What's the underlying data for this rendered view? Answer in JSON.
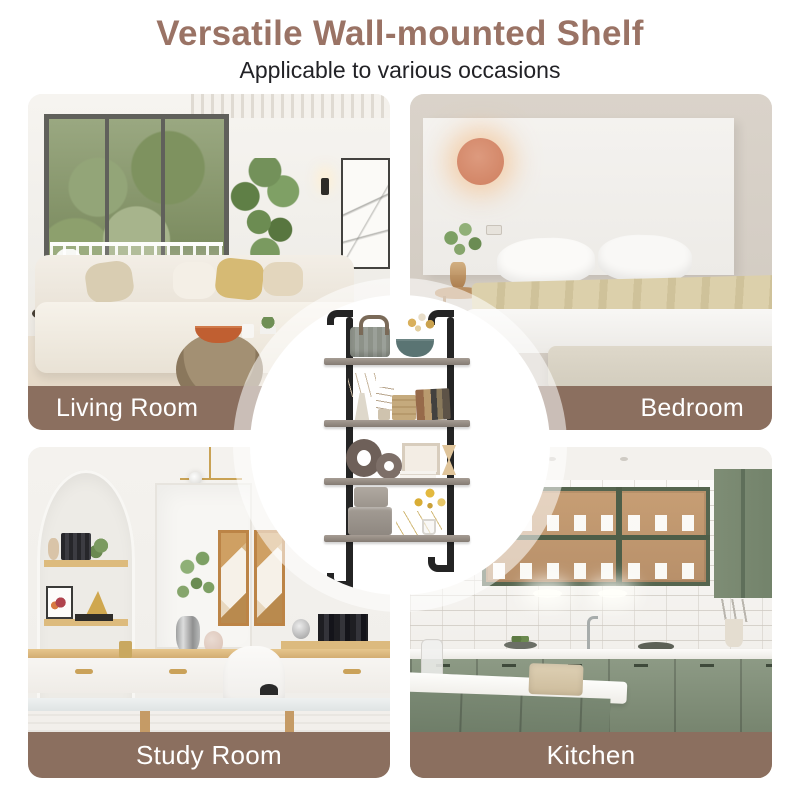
{
  "header": {
    "title": "Versatile Wall-mounted Shelf",
    "subtitle": "Applicable to various occasions"
  },
  "quadrants": [
    {
      "id": "living-room",
      "label": "Living Room",
      "label_align": "left",
      "position": "top-left"
    },
    {
      "id": "bedroom",
      "label": "Bedroom",
      "label_align": "right",
      "position": "top-right"
    },
    {
      "id": "study-room",
      "label": "Study Room",
      "label_align": "center",
      "position": "bottom-left"
    },
    {
      "id": "kitchen",
      "label": "Kitchen",
      "label_align": "center",
      "position": "bottom-right"
    }
  ],
  "center_product": {
    "description": "4-tier black pipe wall-mounted shelf decorated with basket, bowl, vases, books, boxes and plants",
    "tiers": 4
  },
  "colors": {
    "title_brown": "#9a7365",
    "label_bar_brown": "#8b6f5f",
    "label_text_white": "#ffffff",
    "subtitle_dark": "#222226",
    "kitchen_green": "#7d8c74",
    "lamp_orange": "#d98e74",
    "pipe_black": "#242424",
    "shelf_wood_gray": "#958c84"
  }
}
